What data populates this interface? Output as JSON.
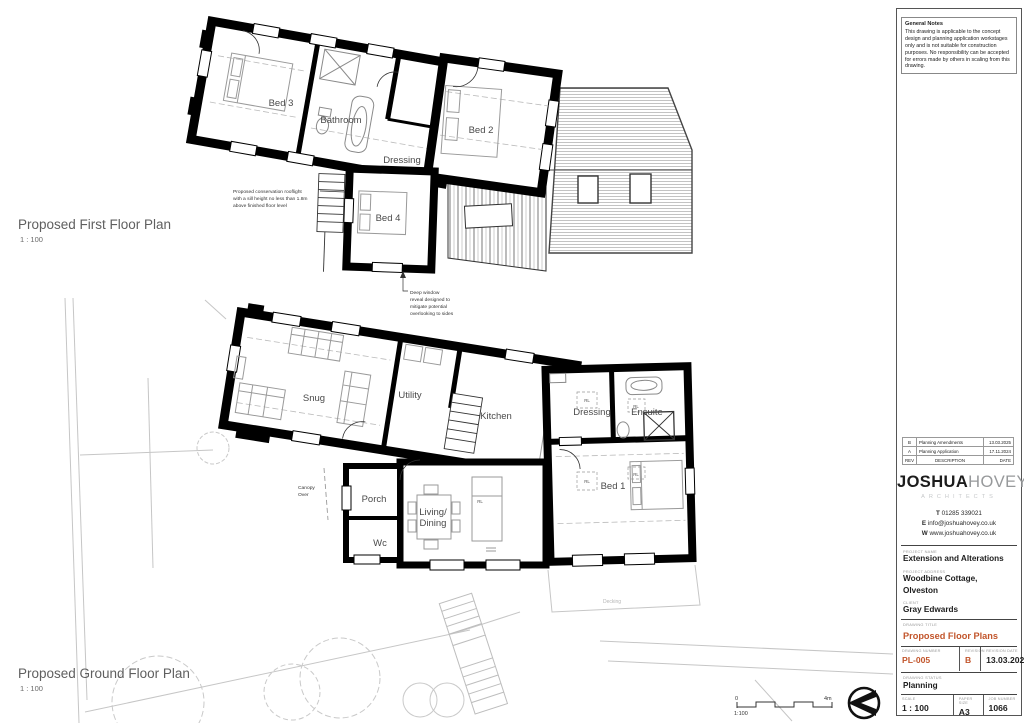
{
  "accent": "#c2552b",
  "general_notes": {
    "title": "General Notes",
    "body": "This drawing is applicable to the concept design and planning application workstages only and is not suitable for construction purposes. No responsibility can be accepted for errors made by others in scaling from this drawing."
  },
  "first_floor": {
    "title": "Proposed First Floor Plan",
    "scale": "1 : 100",
    "rooms": {
      "bed3": "Bed 3",
      "bathroom": "Bathroom",
      "dressing": "Dressing",
      "bed2": "Bed 2",
      "bed4": "Bed 4"
    },
    "annotations": {
      "rooflight": [
        "Proposed conservation rooflight",
        "with a sill height no less than 1.8m",
        "above finished floor level"
      ],
      "window": [
        "Deep window",
        "reveal designed to",
        "mitigate potential",
        "overlooking to sides"
      ]
    }
  },
  "ground_floor": {
    "title": "Proposed Ground Floor Plan",
    "scale": "1 : 100",
    "rooms": {
      "snug": "Snug",
      "utility": "Utility",
      "kitchen": "Kitchen",
      "dressing": "Dressing",
      "ensuite": "Ensuite",
      "bed1": "Bed 1",
      "porch": "Porch",
      "living": "Living/",
      "dining": "Dining",
      "wc": "Wc"
    },
    "rl": "RL",
    "canopy1": "Canopy",
    "canopy2": "Over",
    "decking": "Decking"
  },
  "scale_bar": {
    "zero": "0",
    "max": "4m",
    "ratio": "1:100"
  },
  "title_block": {
    "revisions": [
      {
        "rev": "B",
        "description": "Planning Amendments",
        "date": "13.03.2025"
      },
      {
        "rev": "A",
        "description": "Planning Application",
        "date": "17.11.2024"
      },
      {
        "rev": "REV",
        "description": "DESCRIPTION",
        "date": "DATE"
      }
    ],
    "logo": {
      "part1": "JOSHUA",
      "part2": "HOVEY",
      "sub": "ARCHITECTS"
    },
    "contact": [
      {
        "k": "T",
        "v": "01285 339021"
      },
      {
        "k": "E",
        "v": "info@joshuahovey.co.uk"
      },
      {
        "k": "W",
        "v": "www.joshuahovey.co.uk"
      }
    ],
    "fields": {
      "project_name_label": "PROJECT NAME",
      "project_name": "Extension and Alterations",
      "project_address_label": "PROJECT ADDRESS",
      "project_address1": "Woodbine Cottage,",
      "project_address2": "Olveston",
      "client_label": "CLIENT",
      "client": "Gray Edwards",
      "drawing_title_label": "DRAWING TITLE",
      "drawing_title": "Proposed Floor Plans",
      "drawing_number_label": "DRAWING NUMBER",
      "drawing_number": "PL-005",
      "revision_label": "REVISION",
      "revision": "B",
      "revision_date_label": "REVISION DATE",
      "revision_date": "13.03.2025",
      "drawing_status_label": "DRAWING STATUS",
      "drawing_status": "Planning",
      "scale_label": "SCALE",
      "scale": "1 : 100",
      "paper_size_label": "PAPER SIZE",
      "paper_size": "A3",
      "job_number_label": "JOB NUMBER",
      "job_number": "1066"
    }
  }
}
